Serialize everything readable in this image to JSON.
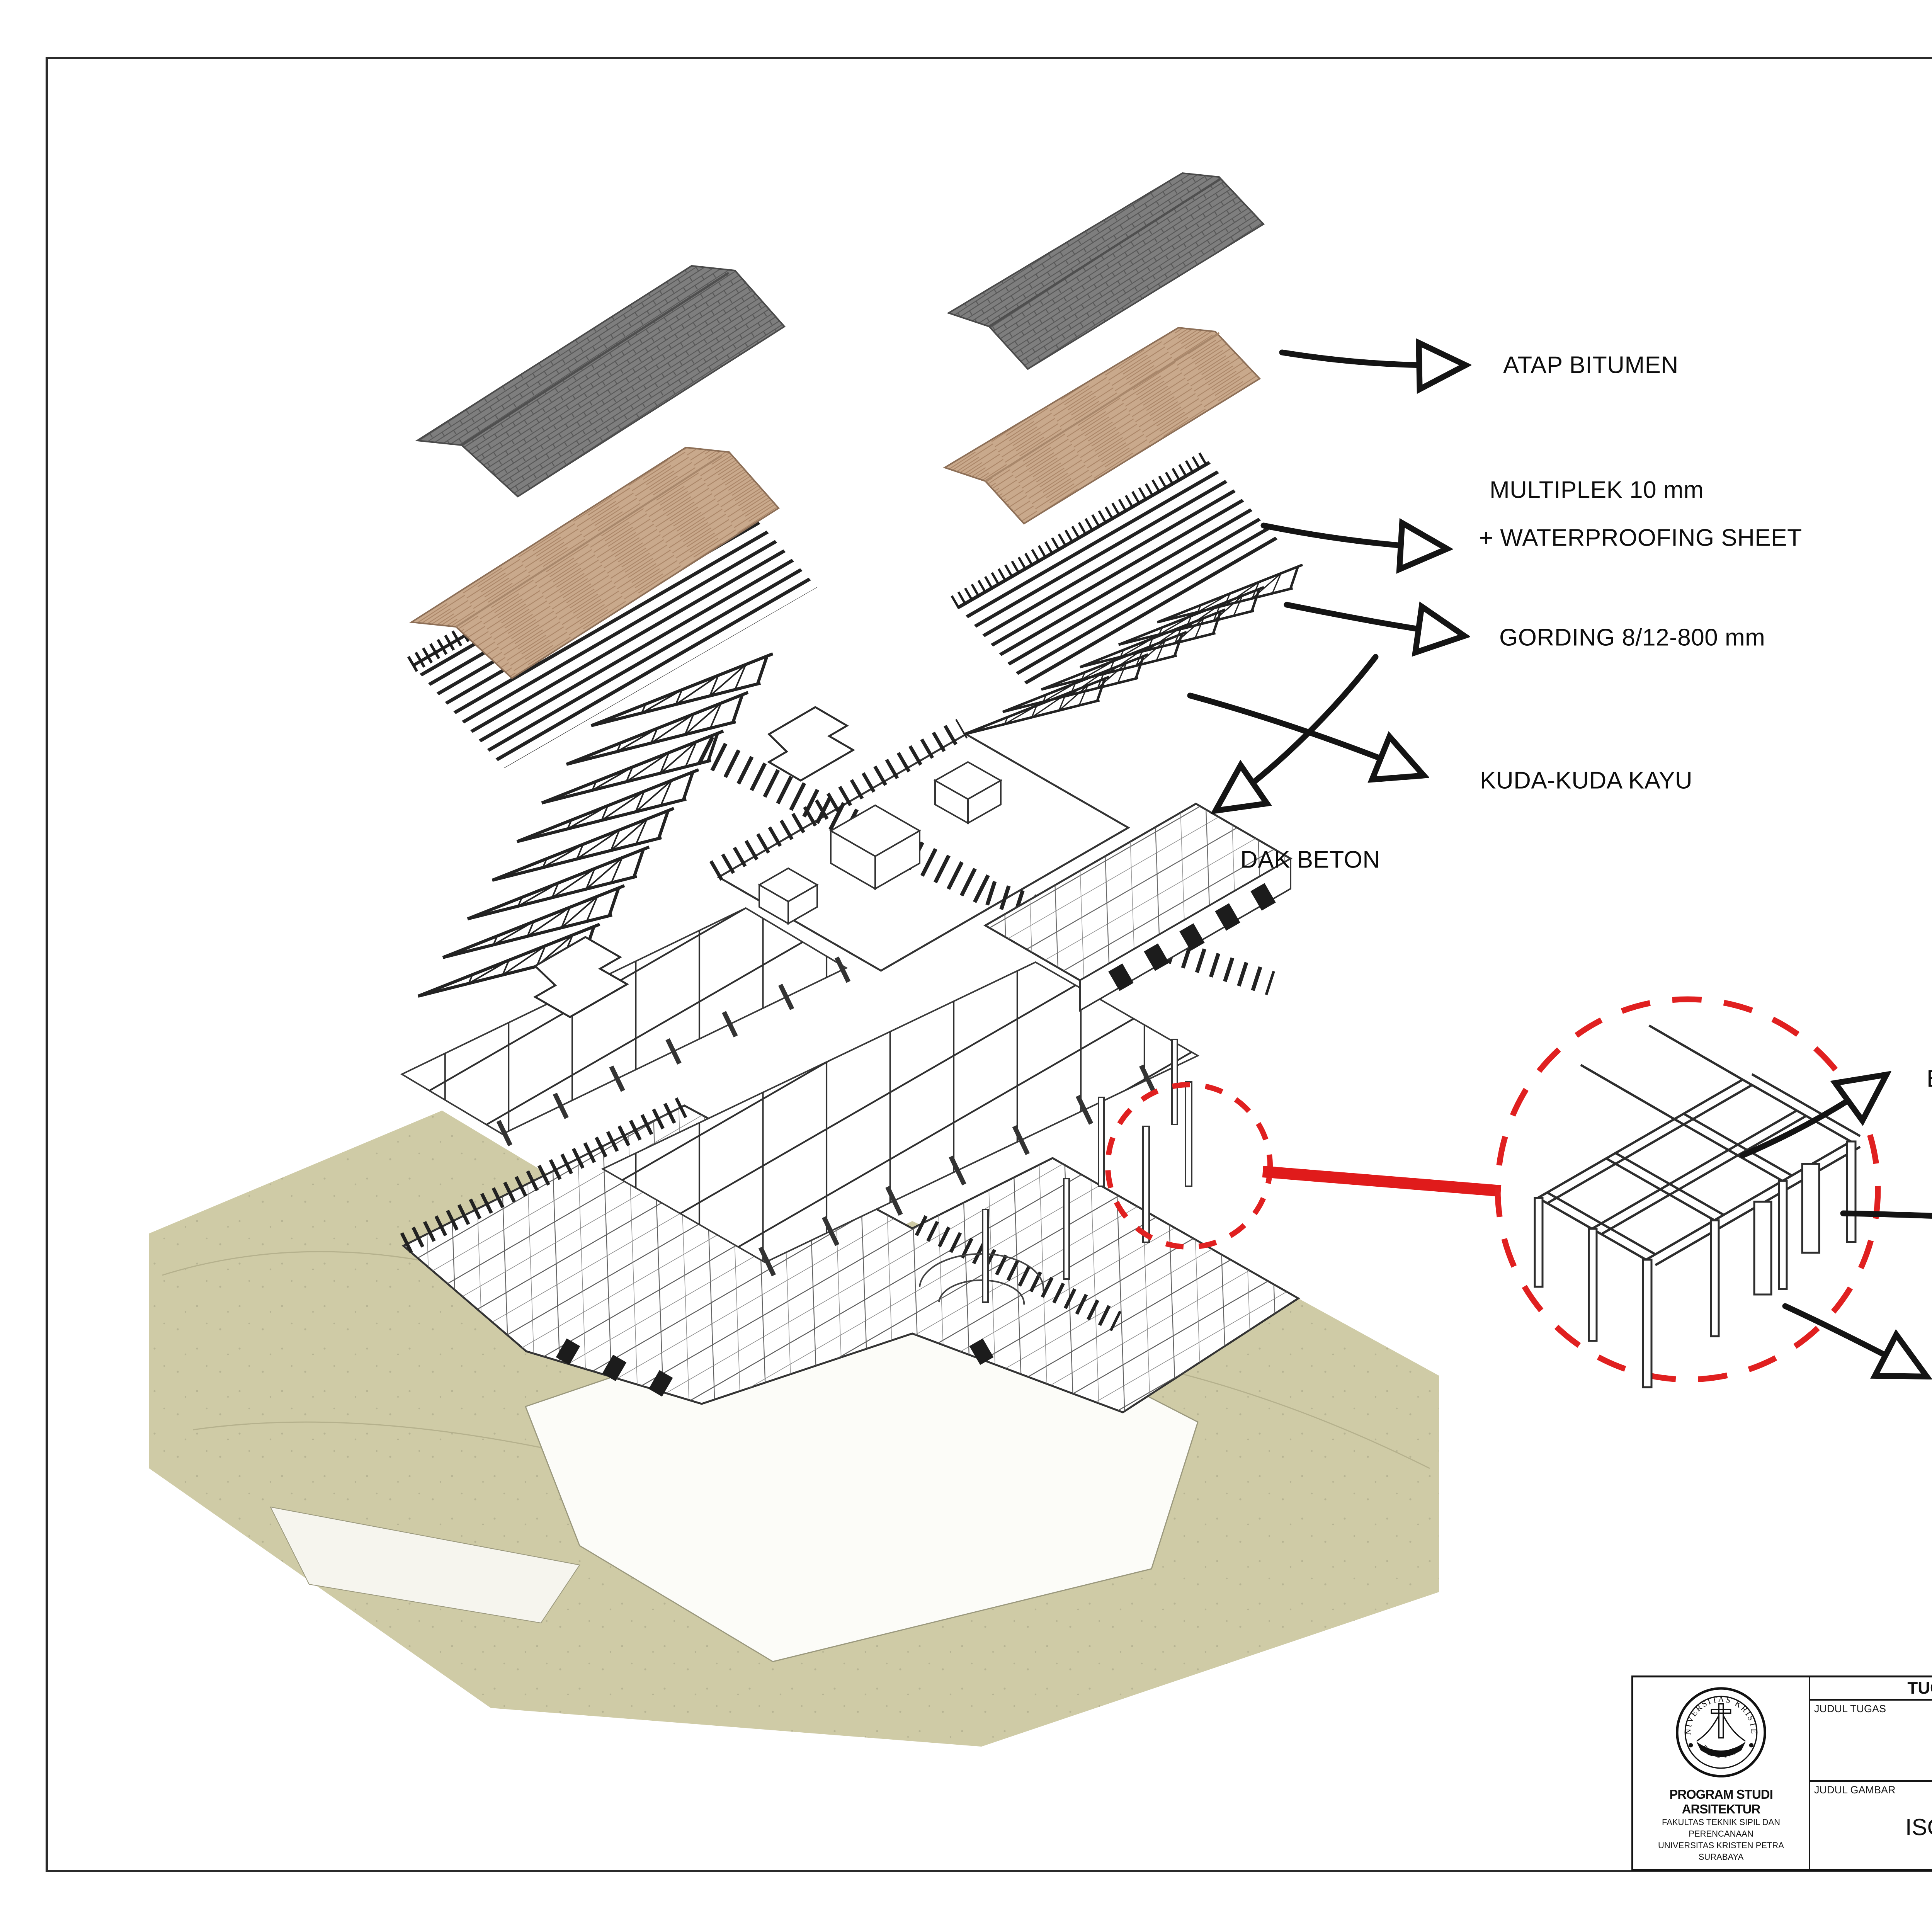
{
  "page": {
    "callouts": {
      "atap": "ATAP BITUMEN",
      "multiplek_1": "MULTIPLEK 10 mm",
      "multiplek_2": "+ WATERPROOFING SHEET",
      "gording": "GORDING 8/12-800 mm",
      "kuda": "KUDA-KUDA KAYU",
      "dak": "DAK BETON",
      "balok": "BALOK BETON",
      "kolom_pipih": "KOLOM BETON PIPIH",
      "kolom": "KOLOM BETON"
    },
    "titleblock": {
      "header": "TUGAS AKHIR - SEMESTER GENAP 2021/2022",
      "judul_tugas_label": "JUDUL TUGAS",
      "judul_tugas_1": "FASILITAS TERAPI PENDERITA",
      "judul_tugas_2": "DEMENSIA DI BATU",
      "judul_gambar_label": "JUDUL GAMBAR",
      "judul_gambar": "ISOMETRI STRUKTUR",
      "skala_label": "SKALA",
      "nama_label": "NAMA",
      "nama": "MATIAS IRVAN RIVALDY",
      "nrp_label": "NRP",
      "nrp": "B12180025",
      "kelompok_label": "KELOMPOK",
      "kelompok": "I",
      "mentor_utama_label": "MENTOR UTAMA",
      "mentor_utama": "RONI ANGGORO, S.T., M.A.(Arch)",
      "mentor_pendamping_label": "MENTOR PENDAMPING",
      "mentor_pendamping_1": "IR. RIDUAN SUKARDI, M.T.",
      "mentor_pendamping_2": "ANIK JUNIWATI, S.T., M.T.",
      "lembar_label": "LEMBAR",
      "jumlah_label": "JUMLAH",
      "institution_1": "PROGRAM STUDI ARSITEKTUR",
      "institution_2": "FAKULTAS TEKNIK SIPIL DAN PERENCANAAN",
      "institution_3": "UNIVERSITAS KRISTEN PETRA",
      "institution_4": "SURABAYA",
      "logo_top": "UNIVERSITAS KRISTEN",
      "logo_bottom": "PETRA"
    },
    "colors": {
      "terrain": "#cfcba6",
      "wood": "#c9a98c",
      "bitumen": "#7e7e7e",
      "accent_red": "#e02020",
      "ink": "#141414"
    }
  }
}
